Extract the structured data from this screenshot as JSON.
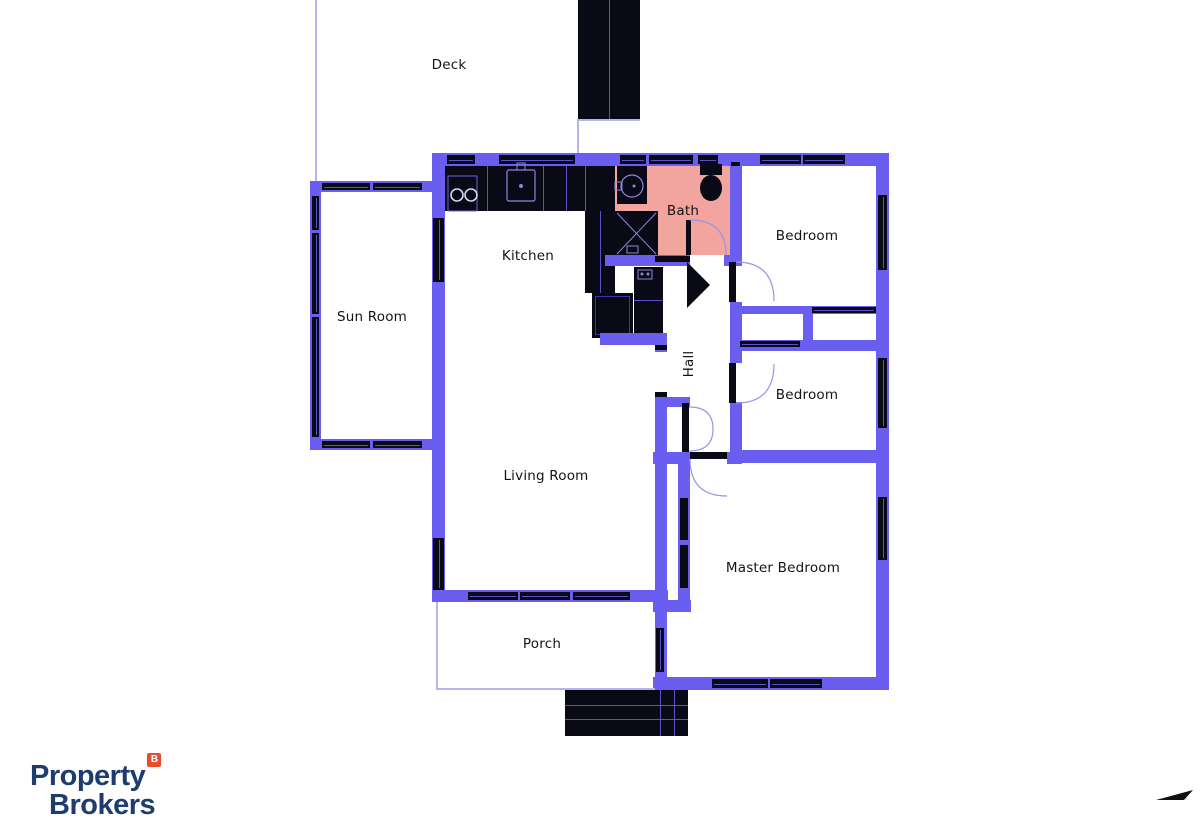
{
  "floorplan": {
    "labels": {
      "deck": "Deck",
      "sun_room": "Sun Room",
      "kitchen": "Kitchen",
      "bath": "Bath",
      "hall": "Hall",
      "bedroom_top": "Bedroom",
      "bedroom_mid": "Bedroom",
      "living_room": "Living Room",
      "master_bedroom": "Master Bedroom",
      "porch": "Porch"
    }
  },
  "branding": {
    "logo_line1": "Property",
    "logo_line2": "Brokers",
    "logo_badge": "B"
  },
  "colors": {
    "wall": "#6a5ef0",
    "thin": "#b7b3ef",
    "dark": "#0a0a16",
    "wline": "#5a52c8",
    "fixline": "#8c86e0",
    "bath": "#f2a49e",
    "label": "#141414",
    "navy": "#1e3c6e",
    "orange": "#e84e2e"
  }
}
